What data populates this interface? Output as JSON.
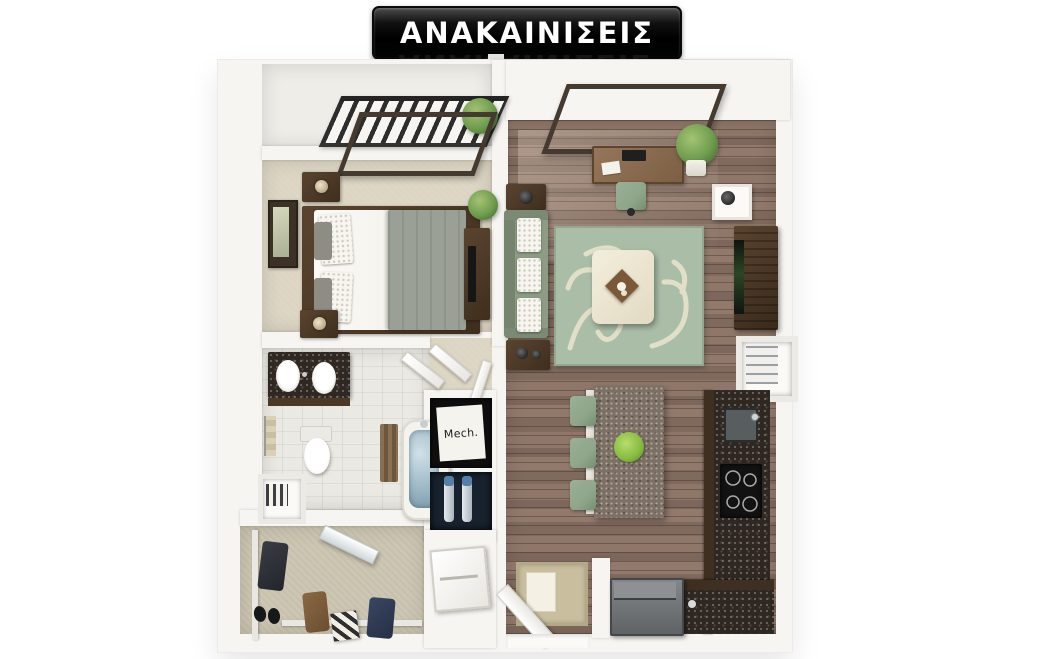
{
  "banner": {
    "title": "ΑΝΑΚΑΙΝΙΣΕΙΣ"
  },
  "plan": {
    "mech_label": "Mech."
  },
  "palette": {
    "banner_bg": "#0c0c0c",
    "banner_text": "#ffffff",
    "wall": "#f7f5f1",
    "wood_floor": "#8a7265",
    "carpet": "#dcd5c3",
    "carpet_closet": "#cdc6b3",
    "tile": "#ebe9e3",
    "rug_green": "#a9bda7",
    "rug_cream": "#e9e3cd",
    "sofa_green": "#8d9c85",
    "counter_granite": "#2f2721",
    "cabinet_wood": "#3f2f20",
    "island_granite": "#7c6f63",
    "furniture_wood": "#4c3827",
    "plant_green": "#6f9c4e",
    "water_blue": "#9db8c6",
    "chair_green": "#8fa68b"
  }
}
